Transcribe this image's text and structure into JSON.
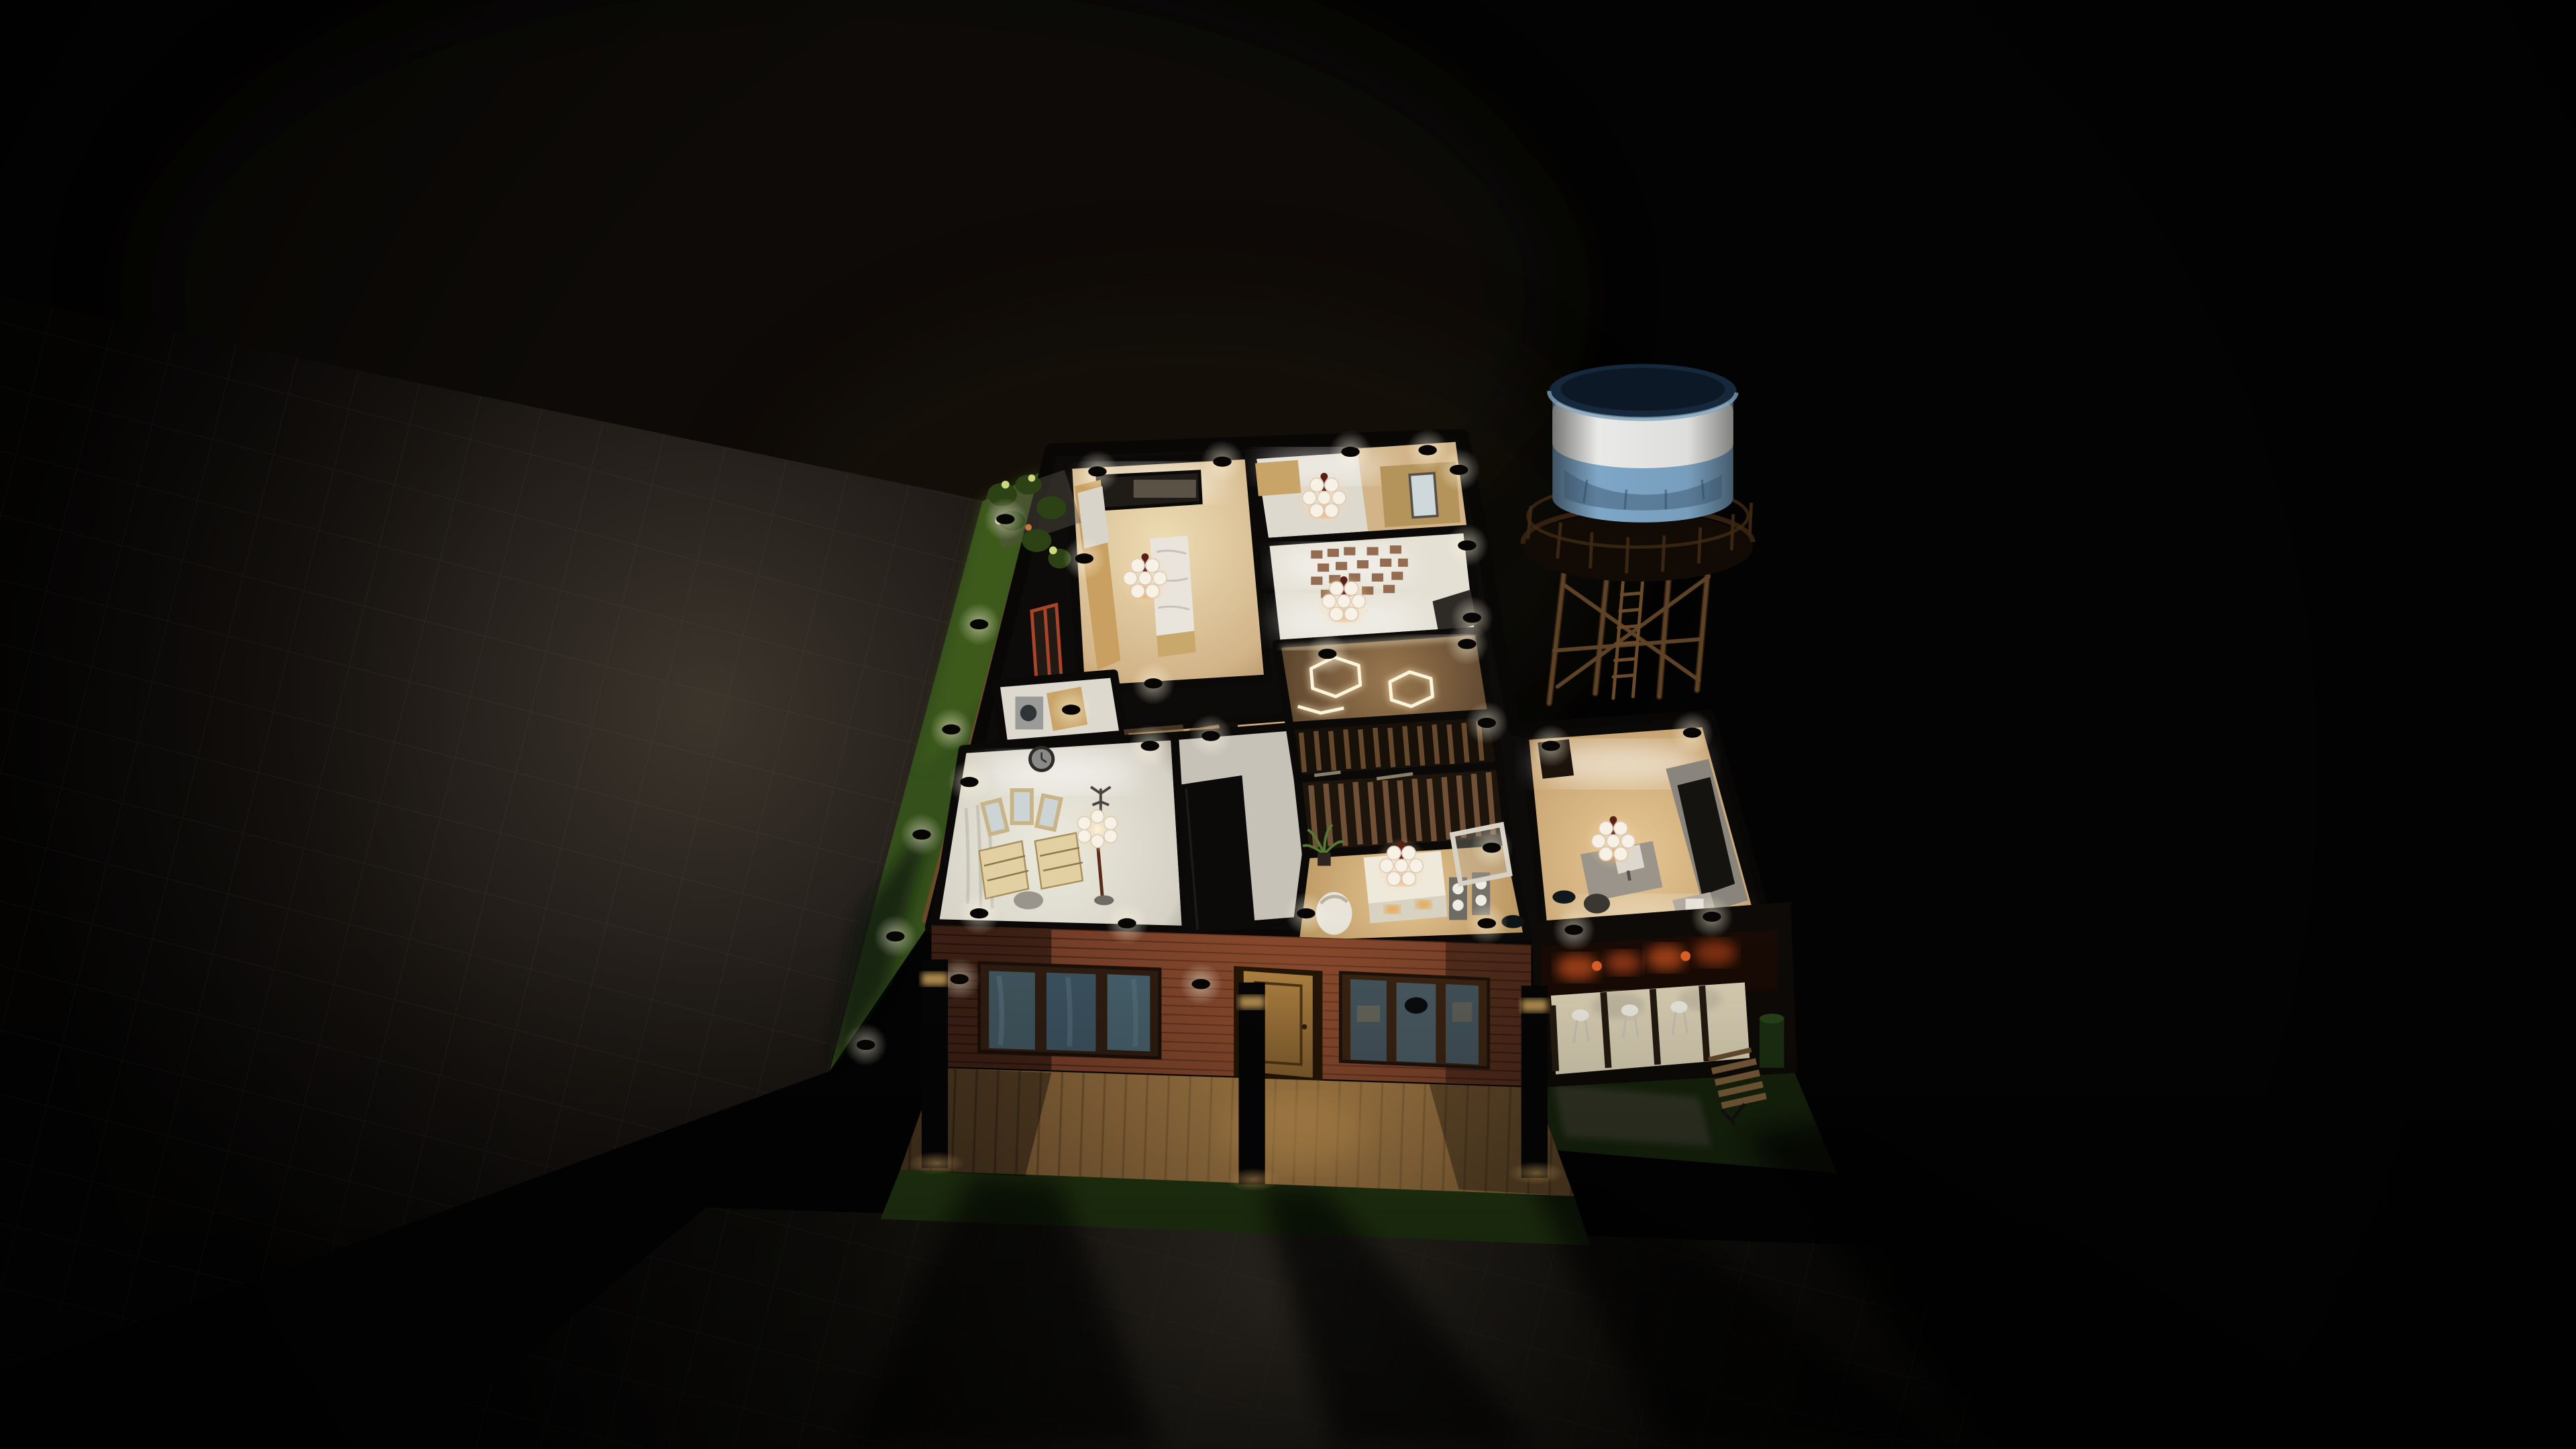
{
  "scene": {
    "description": "Night-time 3D cutaway (dollhouse) rendering of a single-storey house with lit interior rooms, a brick street facade with wooden door and casement windows, front wooden deck with pillar lights, lawn strips, tiled pavement with long cast shadows, and a blue water tower on a wooden trestle",
    "view": "top-down isometric cutaway",
    "time_of_day": "night",
    "rooms": [
      "kitchen",
      "bedroom",
      "workspace with brick feature wall",
      "hallway with hexagon LED floor lights",
      "staircase with wood-slat screens",
      "living-dining room",
      "entry corridor",
      "laundry",
      "dressing room",
      "home office"
    ],
    "objects": [
      "water tower tank",
      "trestle platform",
      "trestle ladder",
      "recessed downlights",
      "chandeliers",
      "marble kitchen island",
      "kitchen cabinets",
      "wall niche",
      "wardrobe with mirror",
      "brick feature wall art",
      "hexagon LED floor lights",
      "wood slat partitions",
      "white sideboard",
      "speaker towers",
      "leaning mirror",
      "egg chair",
      "potted plants",
      "trifold vanity mirror",
      "chests of drawers",
      "stool",
      "shaded floor lamp",
      "coat rack",
      "wall clock",
      "washing machine",
      "desk with monitor",
      "media wall",
      "office chair",
      "printer table",
      "brick facade",
      "triple casement windows",
      "wooden entry door",
      "porch bar with three stools",
      "ember-lit screen",
      "garden bench",
      "green waste bin",
      "stone patio",
      "wooden deck",
      "pillar lights",
      "lawn strips",
      "wooden lawn border",
      "tiled pavement",
      "cast shadows"
    ]
  },
  "colors": {
    "background": "#030303",
    "wall_cut": "#0d0b09",
    "cream_wall": "#e9dfc9",
    "wood_floor": "#d6b98c",
    "white_floor": "#e6e2d8",
    "marble": "#e9e5dd",
    "cabinet_wood": "#c9a062",
    "brick": "#6e3a26",
    "door_wood": "#a5793c",
    "glass_blue": "#41565f",
    "deck_wood": "#7c5a34",
    "lawn": "#35501b",
    "lawn_dark": "#16240c",
    "pillar": "#060505",
    "ember_orange": "#c14d1e",
    "chandelier_glow": "#ff9440",
    "shade_white": "#f7f1e6",
    "tank_blue": "#7ea6c6",
    "tank_band": "#e9eae7",
    "tank_rim": "#16293c",
    "trestle_wood": "#5d4226",
    "slat_wood": "#6b4c2e",
    "hex_glow": "#ffecc2",
    "led_white": "#fff3d0",
    "wardrobe_black": "#0b0a09",
    "bench_wood": "#7d5f3a",
    "bin_green": "#1c3012"
  }
}
